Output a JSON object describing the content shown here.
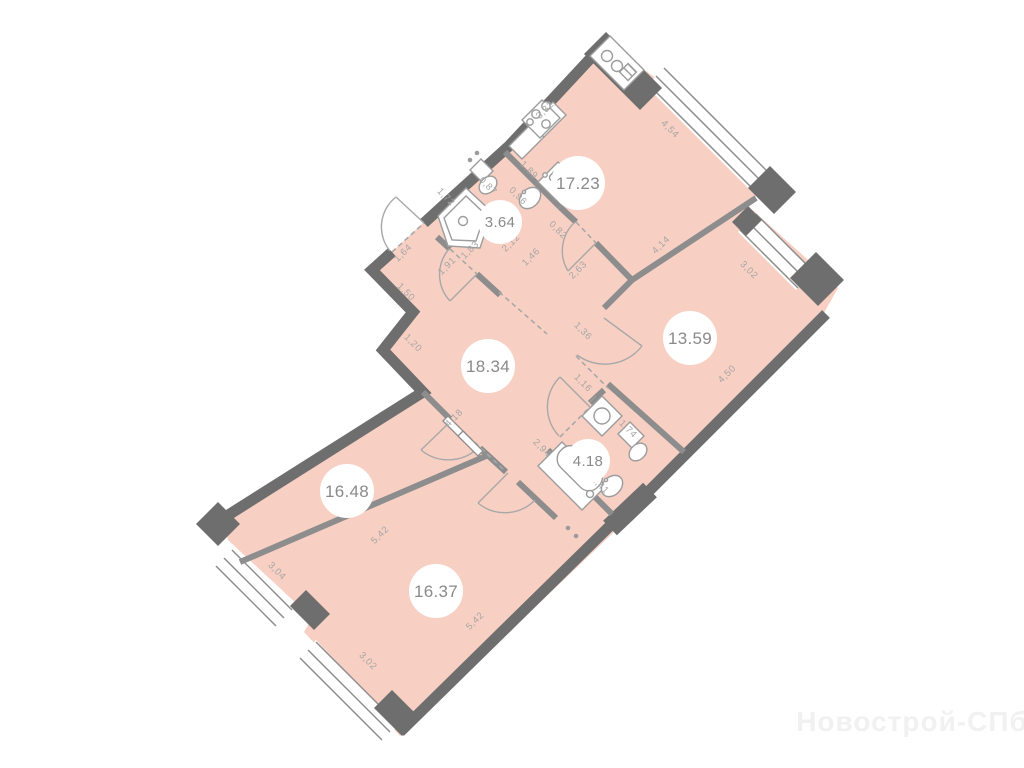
{
  "watermark": "Новострой-СПб",
  "rooms": [
    {
      "id": "kitchen-living",
      "area": "17.23"
    },
    {
      "id": "bathroom-small",
      "area": "3.64"
    },
    {
      "id": "hall",
      "area": "18.34"
    },
    {
      "id": "bedroom-right",
      "area": "13.59"
    },
    {
      "id": "bathroom-large",
      "area": "4.18"
    },
    {
      "id": "bedroom-left",
      "area": "16.48"
    },
    {
      "id": "bedroom-bottom",
      "area": "16.37"
    }
  ],
  "dims": [
    {
      "v": "3,32"
    },
    {
      "v": "4,54"
    },
    {
      "v": "1,89"
    },
    {
      "v": "0,96"
    },
    {
      "v": "0,87"
    },
    {
      "v": "1,72"
    },
    {
      "v": "1,83"
    },
    {
      "v": "1,91"
    },
    {
      "v": "1,64"
    },
    {
      "v": "1,50"
    },
    {
      "v": "1,20"
    },
    {
      "v": "2,12"
    },
    {
      "v": "1,46"
    },
    {
      "v": "0,82"
    },
    {
      "v": "2,63"
    },
    {
      "v": "4,14"
    },
    {
      "v": "3,02"
    },
    {
      "v": "4,50"
    },
    {
      "v": "1,36"
    },
    {
      "v": "1,16"
    },
    {
      "v": "1,74"
    },
    {
      "v": "2,94"
    },
    {
      "v": "2,41"
    },
    {
      "v": "4,18"
    },
    {
      "v": "5,42"
    },
    {
      "v": "3,04"
    },
    {
      "v": "3,02"
    },
    {
      "v": "5,42"
    }
  ],
  "colors": {
    "room_fill": "#f8d0c3",
    "outer_wall": "#6e6e6e",
    "inner_wall": "#8d8d8d",
    "fixture_stroke": "#9c9c9c",
    "dim_text": "#a5a5a5",
    "area_text": "#8a8a8a",
    "watermark": "#f1f1f1"
  }
}
